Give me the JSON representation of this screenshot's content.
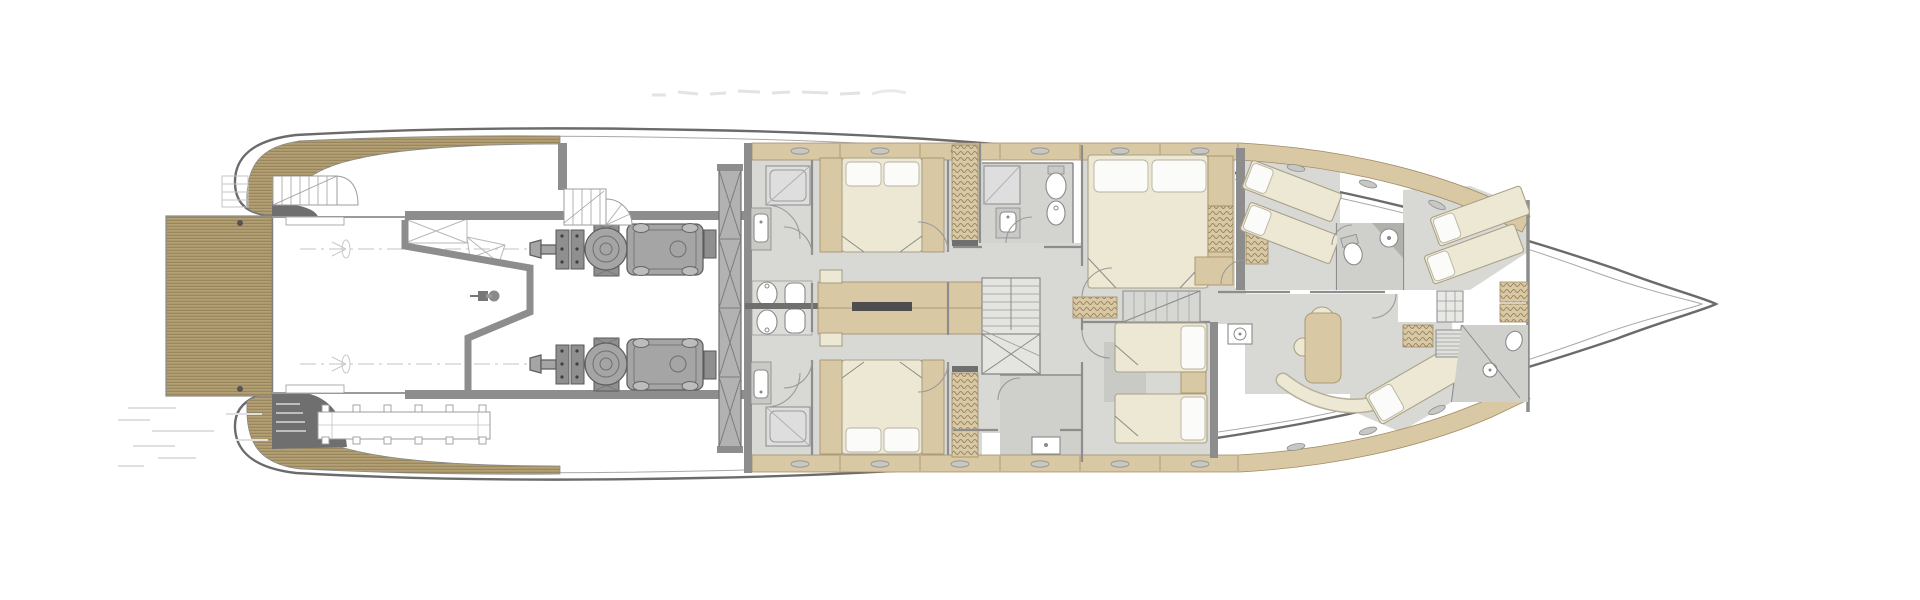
{
  "canvas": {
    "width": 1920,
    "height": 600,
    "background": "#ffffff"
  },
  "palette": {
    "hull-line": "#6b6b6b",
    "inner-line": "#a8a8a8",
    "wall": "#8d8d8d",
    "wall-dark": "#6f6f6f",
    "teak": "#b3a074",
    "teak-line": "#86734c",
    "wood": "#d9c8a4",
    "wood-line": "#a08b64",
    "wood-light": "#e6dabc",
    "floor": "#d8d8d4",
    "bath": "#d1d1cd",
    "bed": "#ede8d3",
    "bed-line": "#a9a28a",
    "pillow": "#fbfbfa",
    "engine": "#a5a5a5",
    "engine-dark": "#606060",
    "tank": "#b2b2b2",
    "ghost": "#dcdcdc",
    "fixture-line": "#8a8a8a",
    "paper": "#ffffff"
  },
  "drawing": {
    "type": "yacht-lower-deck-floor-plan",
    "orientation": "bow-right",
    "text_labels": [],
    "regions": [
      {
        "id": "swim-platform"
      },
      {
        "id": "transom-garage"
      },
      {
        "id": "aft-stairs"
      },
      {
        "id": "boarding-ladder"
      },
      {
        "id": "transom-bench"
      },
      {
        "id": "tender-bay"
      },
      {
        "id": "engine-room"
      },
      {
        "id": "port-engine"
      },
      {
        "id": "starboard-engine"
      },
      {
        "id": "spiral-staircase"
      },
      {
        "id": "fuel-tank-bulkhead"
      },
      {
        "id": "guest-bathroom-port"
      },
      {
        "id": "guest-bathroom-starboard"
      },
      {
        "id": "guest-cabin-aft-port"
      },
      {
        "id": "guest-cabin-aft-starboard"
      },
      {
        "id": "central-lobby"
      },
      {
        "id": "main-staircase"
      },
      {
        "id": "day-head"
      },
      {
        "id": "vip-cabin"
      },
      {
        "id": "twin-cabin"
      },
      {
        "id": "crew-stairs"
      },
      {
        "id": "crew-corridor"
      },
      {
        "id": "crew-mess"
      },
      {
        "id": "crew-cabin-port"
      },
      {
        "id": "crew-cabin-bow"
      },
      {
        "id": "crew-cabin-starboard"
      },
      {
        "id": "crew-bathroom-port"
      },
      {
        "id": "crew-bathroom-starboard"
      },
      {
        "id": "forepeak"
      },
      {
        "id": "bow"
      }
    ],
    "furniture_counts": {
      "double-beds": 3,
      "twin-beds": 2,
      "crew-bunks": 5,
      "toilets": 4,
      "showers": 5,
      "sinks": 8,
      "engines": 2,
      "staircases": 4
    }
  }
}
